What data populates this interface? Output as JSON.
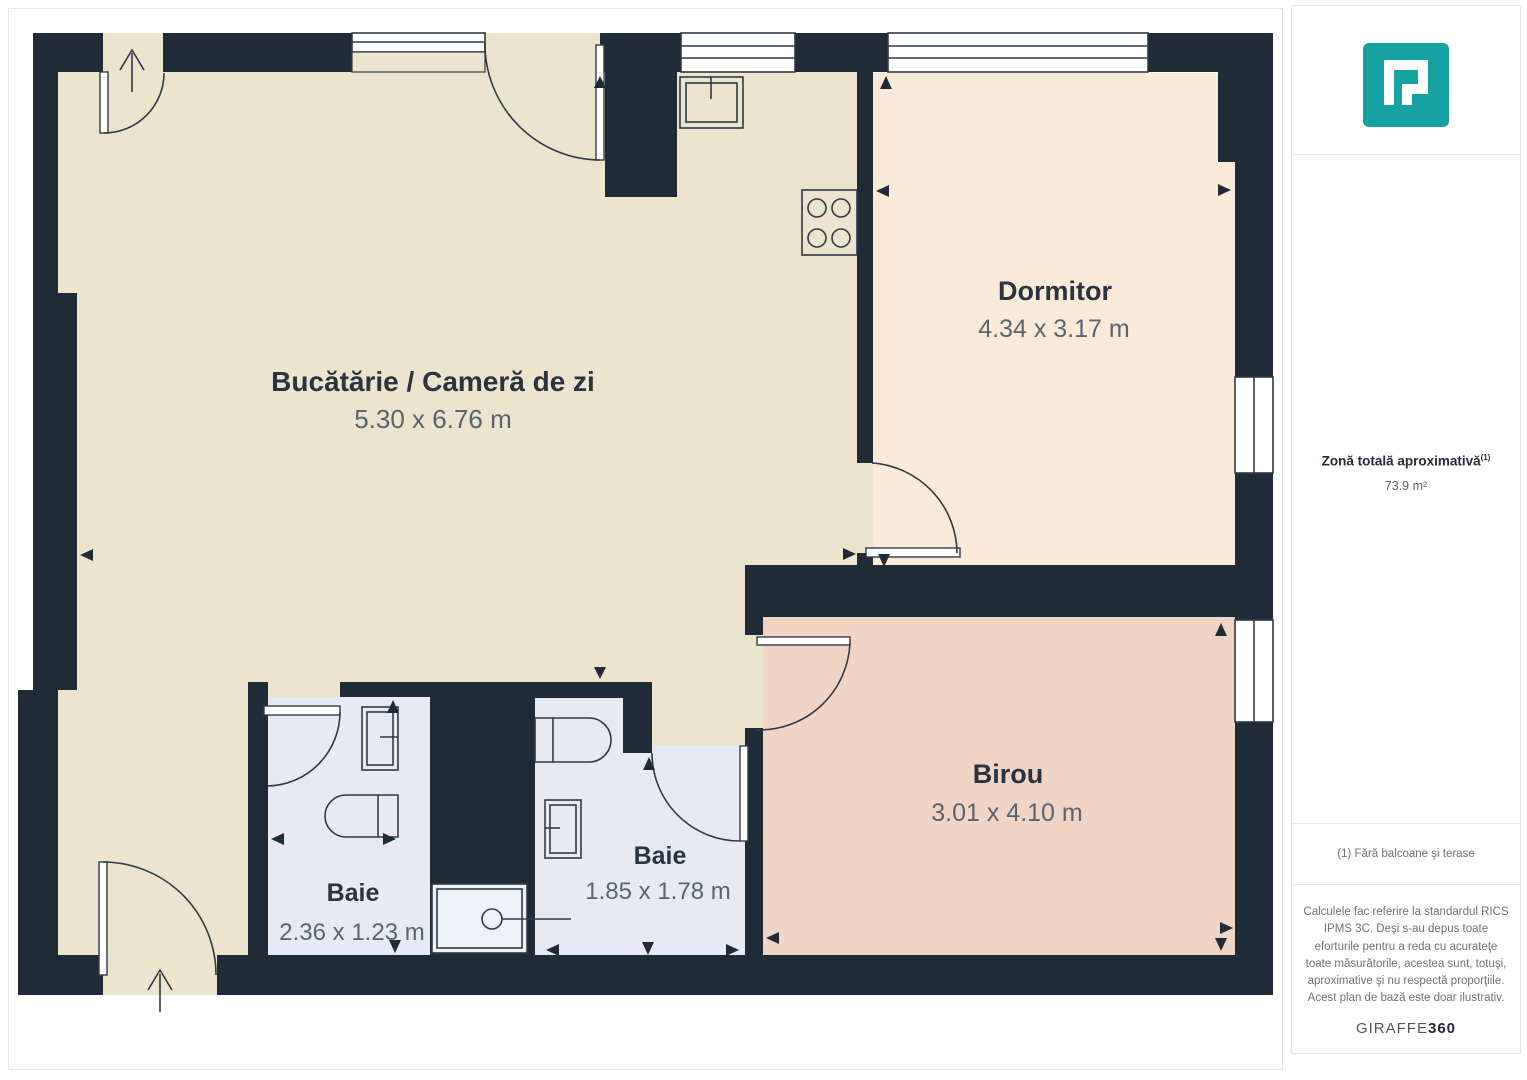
{
  "plan": {
    "rooms": [
      {
        "name": "Bucătărie / Cameră de zi",
        "dims": "5.30 x 6.76 m"
      },
      {
        "name": "Dormitor",
        "dims": "4.34 x 3.17 m"
      },
      {
        "name": "Birou",
        "dims": "3.01 x 4.10 m"
      },
      {
        "name": "Baie",
        "dims": "2.36 x 1.23 m"
      },
      {
        "name": "Baie",
        "dims": "1.85 x 1.78 m"
      }
    ]
  },
  "sidebar": {
    "total_area_label": "Zonă totală aproximativă",
    "total_area_note_marker": "(1)",
    "total_area_value": "73.9 m²",
    "footnote": "(1) Fără balcoane şi terase",
    "disclaimer": "Calculele fac referire la standardul RICS IPMS 3C. Deşi s-au depus toate eforturile pentru a reda cu acurateţe toate măsurătorile, acestea sunt, totuşi, aproximative şi nu respectă proporţiile. Acest plan de bază este doar ilustrativ.",
    "brand_name": "GIRAFFE",
    "brand_suffix": "360"
  },
  "colors": {
    "wall": "#202b38",
    "floor_kitchen": "#ece4cc",
    "floor_bedroom": "#fcead8",
    "floor_office": "#f0d5c5",
    "floor_bath": "#e7eaf2",
    "shower": "#eef1f5",
    "logo_teal": "#17a2a2",
    "label_dark": "#2a3440",
    "label_gray": "#596470"
  }
}
